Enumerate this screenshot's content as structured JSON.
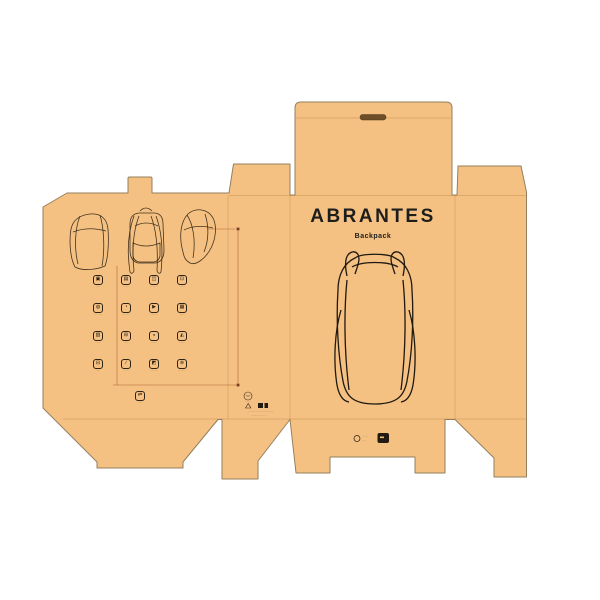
{
  "colors": {
    "board": "#f4c183",
    "edge": "#94805e",
    "ink": "#241b10",
    "callout": "#a4552a"
  },
  "front_panel": {
    "brand": "ABRANTES",
    "product": "Backpack"
  },
  "back_panel": {
    "views": [
      "backpack-side-view",
      "backpack-back-view",
      "backpack-profile-view"
    ],
    "features": [
      {
        "glyph": "▣",
        "label": "·····"
      },
      {
        "glyph": "▤",
        "label": "······"
      },
      {
        "glyph": "◫",
        "label": "·········"
      },
      {
        "glyph": "⊡",
        "label": "·······"
      },
      {
        "glyph": "◍",
        "label": "··········"
      },
      {
        "glyph": "◔",
        "label": "········"
      },
      {
        "glyph": "▶",
        "label": "·········"
      },
      {
        "glyph": "▦",
        "label": "·······"
      },
      {
        "glyph": "▧",
        "label": "······"
      },
      {
        "glyph": "⊞",
        "label": "·····"
      },
      {
        "glyph": "◒",
        "label": "·······"
      },
      {
        "glyph": "◭",
        "label": "······"
      },
      {
        "glyph": "⊟",
        "label": "·····"
      },
      {
        "glyph": "∕",
        "label": "······"
      },
      {
        "glyph": "◩",
        "label": "········"
      },
      {
        "glyph": "⊛",
        "label": "·········"
      },
      {
        "glyph": "⇄",
        "label": "·····"
      }
    ]
  },
  "side_panel": {
    "cert_caption": "·······",
    "fine_print_1": "·································",
    "fine_print_2": "···················"
  },
  "front_flap": {
    "logo_text_1": "·······",
    "logo_text_2": "·····"
  }
}
